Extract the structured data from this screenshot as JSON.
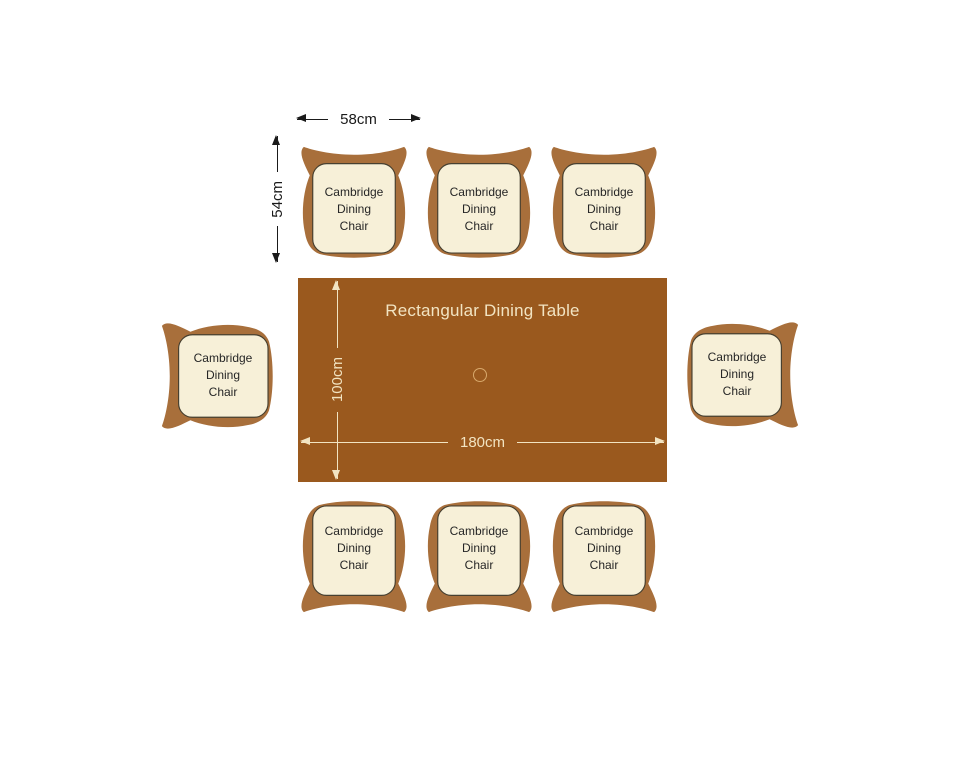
{
  "table": {
    "label": "Rectangular Dining Table",
    "length_label": "180cm",
    "width_label": "100cm"
  },
  "chair": {
    "name_lines": [
      "Cambridge",
      "Dining",
      "Chair"
    ],
    "width_label": "58cm",
    "depth_label": "54cm",
    "count": 8
  },
  "colors": {
    "table": "#9A591E",
    "chair_body": "#A86F3B",
    "cushion": "#F7F0D8",
    "cushion_border": "#474030",
    "table_text": "#F2E4C2",
    "hole_ring": "#D8A96C",
    "dim_dark": "#1A1A1A"
  }
}
